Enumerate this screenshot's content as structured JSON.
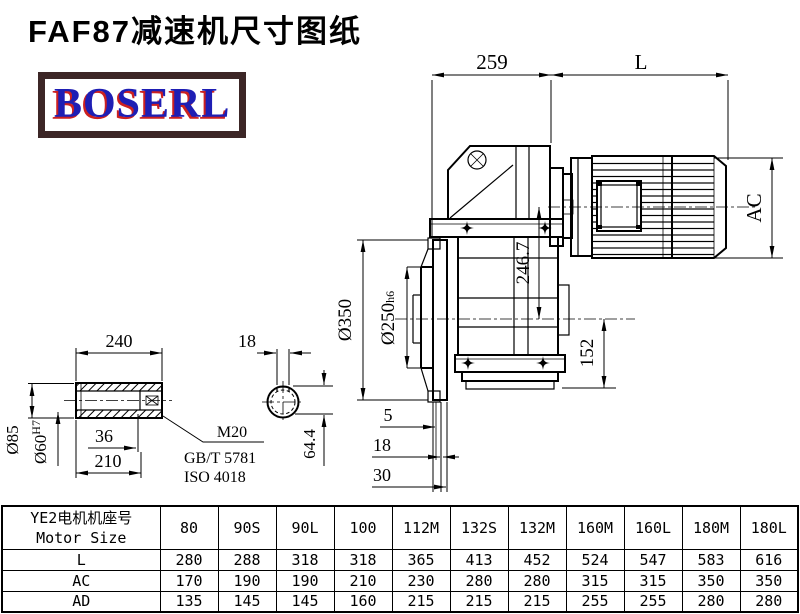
{
  "page": {
    "title": "FAF87减速机尺寸图纸",
    "logo_text": "BOSERL"
  },
  "dims": {
    "d259": "259",
    "dL": "L",
    "dAC": "AC",
    "d246": "246.7",
    "d152": "152",
    "d350": "Ø350",
    "d250": "Ø250",
    "d250tol": "h6",
    "d5": "5",
    "d18b": "18",
    "d30": "30",
    "d240": "240",
    "d85": "Ø85",
    "d60": "Ø60",
    "d60tol": "H7",
    "d36": "36",
    "d210": "210",
    "m20": "M20",
    "gb": "GB/T 5781",
    "iso": "ISO 4018",
    "d18c": "18",
    "d644": "64.4"
  },
  "table": {
    "header_cn": "YE2电机机座号",
    "header_en": "Motor Size",
    "columns": [
      "80",
      "90S",
      "90L",
      "100",
      "112M",
      "132S",
      "132M",
      "160M",
      "160L",
      "180M",
      "180L"
    ],
    "rows": [
      {
        "label": "L",
        "values": [
          "280",
          "288",
          "318",
          "318",
          "365",
          "413",
          "452",
          "524",
          "547",
          "583",
          "616"
        ]
      },
      {
        "label": "AC",
        "values": [
          "170",
          "190",
          "190",
          "210",
          "230",
          "280",
          "280",
          "315",
          "315",
          "350",
          "350"
        ]
      },
      {
        "label": "AD",
        "values": [
          "135",
          "145",
          "145",
          "160",
          "215",
          "215",
          "215",
          "255",
          "255",
          "280",
          "280"
        ]
      }
    ]
  },
  "colors": {
    "line": "#000000",
    "logo_blue": "#1e1eb4",
    "logo_red": "#cc2020",
    "logo_frame": "#3c2626"
  }
}
